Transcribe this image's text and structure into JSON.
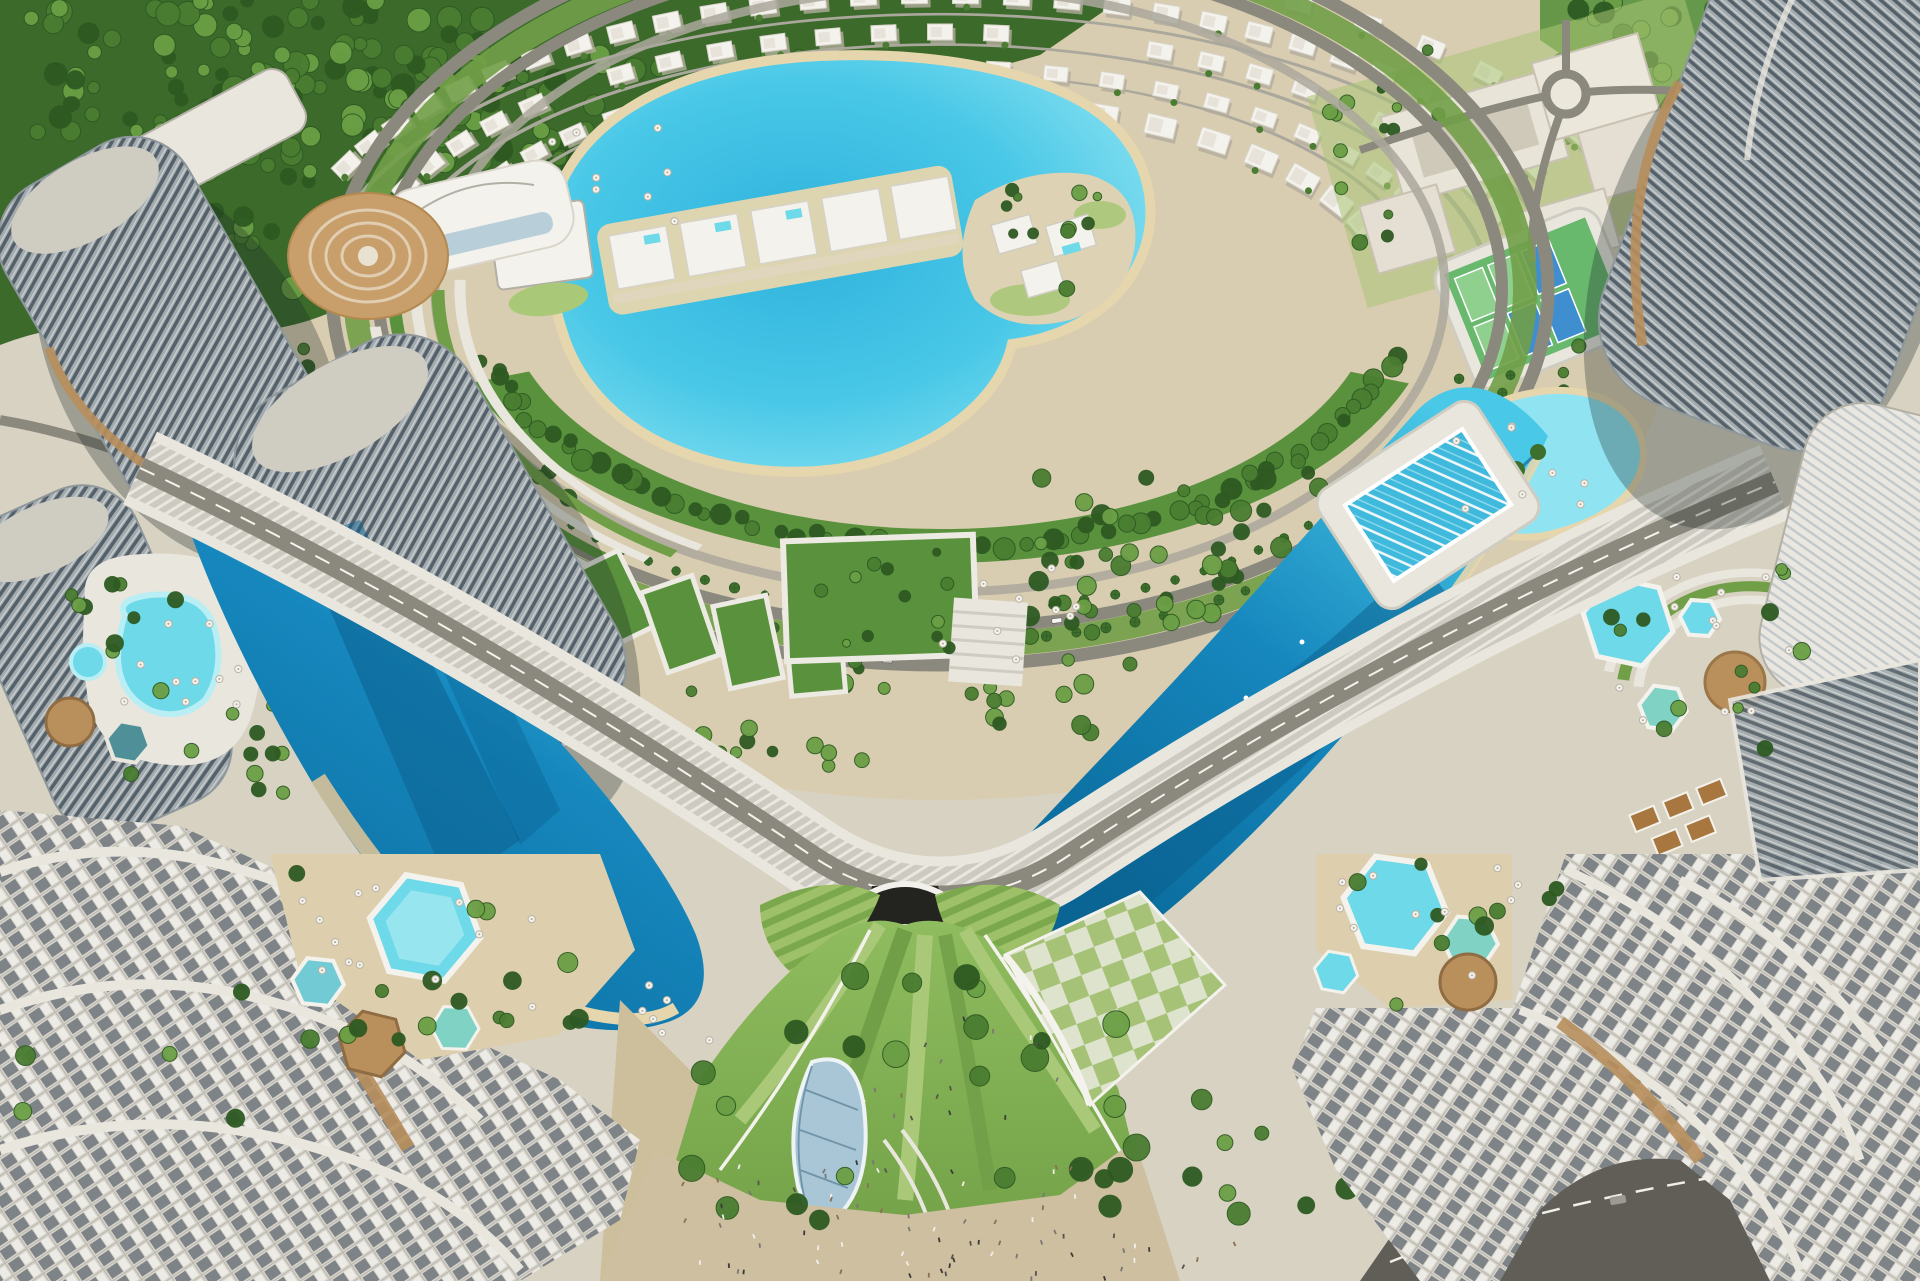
{
  "palette": {
    "ground": "#d8d2c2",
    "groundWarm": "#dbc9a4",
    "sandPath": "#cdbf9b",
    "beach": "#e6d6ad",
    "forestDark": "#3c6a2b",
    "forestMid": "#59913d",
    "lawn": "#8cb45e",
    "lawnLight": "#a9c878",
    "lawnDark": "#719f48",
    "treeDark": "#2e5a22",
    "treeMid": "#4a7d31",
    "treeLight": "#6b9f45",
    "palmGreen": "#3d6f2d",
    "lagoonCore": "#2fb2dd",
    "lagoonMid": "#49c8e7",
    "lagoonLight": "#90e4f2",
    "lagoonDeep": "#1687bd",
    "lagoonAbyss": "#0b6c9d",
    "lagoonShadow": "#0a5d8c",
    "poolAqua": "#6ed9e8",
    "poolPale": "#b8eef4",
    "roadLight": "#aaa79c",
    "roadMid": "#8b897e",
    "roadDark": "#6f6d64",
    "asphalt": "#605e57",
    "white": "#f4f2ec",
    "offWhite": "#e9e6de",
    "concrete": "#cfccc2",
    "concreteShade": "#b2afa4",
    "towerFacade": "#a2aaad",
    "windowDark": "#515e66",
    "bronze": "#b78e5c",
    "wood": "#b98f5c",
    "glass": "#a9c6d6",
    "glassDark": "#6f93a8",
    "tan": "#c89f6b",
    "checkerLight": "#dde3cc",
    "courtGreen": "#68b86d",
    "courtBlue": "#3f8fd0",
    "shadow": "rgba(25,40,35,0.30)"
  },
  "generators": {
    "treeClusters": [
      {
        "layer": "gen-forest",
        "x": 30,
        "y": 0,
        "w": 460,
        "h": 140,
        "n": 95,
        "rmin": 6,
        "rmax": 13,
        "seed": 11
      },
      {
        "layer": "gen-forest",
        "x": 380,
        "y": 55,
        "w": 340,
        "h": 120,
        "n": 60,
        "rmin": 6,
        "rmax": 12,
        "seed": 12
      },
      {
        "layer": "gen-forest",
        "x": 150,
        "y": 120,
        "w": 280,
        "h": 170,
        "n": 55,
        "rmin": 6,
        "rmax": 12,
        "seed": 13
      },
      {
        "layer": "gen-forest",
        "x": 520,
        "y": 130,
        "w": 230,
        "h": 120,
        "n": 38,
        "rmin": 5,
        "rmax": 10,
        "seed": 14
      },
      {
        "layer": "gen-forest",
        "x": 690,
        "y": 55,
        "w": 260,
        "h": 100,
        "n": 32,
        "rmin": 5,
        "rmax": 10,
        "seed": 15
      },
      {
        "layer": "gen-forest",
        "x": 40,
        "y": 210,
        "w": 210,
        "h": 130,
        "n": 40,
        "rmin": 6,
        "rmax": 12,
        "seed": 16
      },
      {
        "layer": "gen-forest",
        "x": 1555,
        "y": 0,
        "w": 365,
        "h": 150,
        "n": 60,
        "rmin": 6,
        "rmax": 11,
        "seed": 17
      },
      {
        "layer": "gen-forest",
        "x": 1690,
        "y": 140,
        "w": 230,
        "h": 120,
        "n": 26,
        "rmin": 5,
        "rmax": 10,
        "seed": 18
      },
      {
        "layer": "gen-campus-trees",
        "x": 1330,
        "y": 50,
        "w": 110,
        "h": 200,
        "n": 15,
        "rmin": 4,
        "rmax": 8,
        "seed": 19
      },
      {
        "layer": "gen-campus-trees",
        "x": 1650,
        "y": 130,
        "w": 110,
        "h": 130,
        "n": 10,
        "rmin": 4,
        "rmax": 8,
        "seed": 20
      },
      {
        "layer": "gen-flank-trees",
        "x": 300,
        "y": 380,
        "w": 170,
        "h": 190,
        "n": 22,
        "rmin": 5,
        "rmax": 10,
        "seed": 21
      },
      {
        "layer": "gen-flank-trees",
        "x": 1040,
        "y": 470,
        "w": 360,
        "h": 170,
        "n": 44,
        "rmin": 6,
        "rmax": 11,
        "seed": 22
      },
      {
        "layer": "gen-flank-trees",
        "x": 450,
        "y": 470,
        "w": 120,
        "h": 130,
        "n": 12,
        "rmin": 5,
        "rmax": 9,
        "seed": 23
      },
      {
        "layer": "gen-flank-trees",
        "x": 560,
        "y": 660,
        "w": 340,
        "h": 110,
        "n": 28,
        "rmin": 5,
        "rmax": 9,
        "seed": 33
      },
      {
        "layer": "gen-flank-trees",
        "x": 960,
        "y": 560,
        "w": 340,
        "h": 180,
        "n": 38,
        "rmin": 6,
        "rmax": 10,
        "seed": 34
      },
      {
        "layer": "gen-flank-trees",
        "x": 150,
        "y": 520,
        "w": 150,
        "h": 280,
        "n": 16,
        "rmin": 4,
        "rmax": 8,
        "seed": 31
      },
      {
        "layer": "gen-park-trees",
        "x": 660,
        "y": 950,
        "w": 480,
        "h": 280,
        "n": 26,
        "rmin": 8,
        "rmax": 14,
        "seed": 24
      },
      {
        "layer": "gen-park-trees",
        "x": 1150,
        "y": 1050,
        "w": 200,
        "h": 180,
        "n": 9,
        "rmin": 7,
        "rmax": 12,
        "seed": 32
      },
      {
        "layer": "gen-deck-trees-left",
        "x": 60,
        "y": 560,
        "w": 220,
        "h": 230,
        "n": 15,
        "rmin": 5,
        "rmax": 9,
        "seed": 25
      },
      {
        "layer": "gen-deck-trees-bl",
        "x": 280,
        "y": 860,
        "w": 350,
        "h": 190,
        "n": 12,
        "rmin": 6,
        "rmax": 10,
        "seed": 26
      },
      {
        "layer": "gen-deck-trees-bl",
        "x": 20,
        "y": 980,
        "w": 380,
        "h": 260,
        "n": 10,
        "rmin": 6,
        "rmax": 10,
        "seed": 35
      },
      {
        "layer": "gen-deck-trees-br",
        "x": 1300,
        "y": 860,
        "w": 300,
        "h": 160,
        "n": 10,
        "rmin": 6,
        "rmax": 10,
        "seed": 27
      },
      {
        "layer": "gen-amenity-trees",
        "x": 1580,
        "y": 560,
        "w": 230,
        "h": 210,
        "n": 13,
        "rmin": 5,
        "rmax": 9,
        "seed": 28
      },
      {
        "layer": "gen-island-trees",
        "x": 975,
        "y": 185,
        "w": 150,
        "h": 140,
        "n": 11,
        "rmin": 4,
        "rmax": 8,
        "seed": 29
      },
      {
        "layer": "gen-plot-trees",
        "x": 795,
        "y": 545,
        "w": 165,
        "h": 105,
        "n": 12,
        "rmin": 4,
        "rmax": 7,
        "seed": 30
      }
    ],
    "treeArcs": [
      {
        "layer": "gen-belt-trees",
        "cx": 940,
        "cy": 290,
        "rx": 468,
        "ry": 256,
        "a0": 15,
        "a1": 165,
        "n": 64,
        "rmin": 6,
        "rmax": 11,
        "jx": 16,
        "jy": 12,
        "seed": 41
      },
      {
        "layer": "gen-belt-trees",
        "cx": 940,
        "cy": 290,
        "rx": 640,
        "ry": 415,
        "a0": 140,
        "a1": 172,
        "n": 11,
        "rmin": 5,
        "rmax": 9,
        "jx": 10,
        "jy": 8,
        "seed": 42
      },
      {
        "layer": "gen-belt-trees",
        "cx": 940,
        "cy": 290,
        "rx": 640,
        "ry": 415,
        "a0": 8,
        "a1": 40,
        "n": 11,
        "rmin": 5,
        "rmax": 9,
        "jx": 10,
        "jy": 8,
        "seed": 43
      }
    ],
    "villaRows": [
      {
        "cx": 940,
        "cy": 290,
        "rx": 655,
        "ry": 295,
        "a0": 205,
        "a1": 335,
        "n": 30,
        "w": 26,
        "h": 17,
        "seed": 51
      },
      {
        "cx": 940,
        "cy": 290,
        "rx": 583,
        "ry": 258,
        "a0": 198,
        "a1": 342,
        "n": 27,
        "w": 25,
        "h": 16,
        "seed": 52
      },
      {
        "cx": 940,
        "cy": 290,
        "rx": 515,
        "ry": 222,
        "a0": 192,
        "a1": 348,
        "n": 25,
        "w": 24,
        "h": 15,
        "seed": 53
      },
      {
        "cx": 940,
        "cy": 290,
        "rx": 450,
        "ry": 188,
        "a0": 218,
        "a1": 340,
        "n": 16,
        "w": 30,
        "h": 20,
        "seed": 54
      },
      {
        "cx": 940,
        "cy": 290,
        "rx": 725,
        "ry": 330,
        "a0": 248,
        "a1": 332,
        "n": 14,
        "w": 26,
        "h": 17,
        "seed": 55
      }
    ],
    "palmArcs": [
      {
        "cx": 940,
        "cy": 290,
        "rx": 588,
        "ry": 352,
        "a0": 14,
        "a1": 166,
        "n": 52,
        "seed": 61
      },
      {
        "cx": 940,
        "cy": 290,
        "rx": 540,
        "ry": 322,
        "a0": 16,
        "a1": 164,
        "n": 44,
        "seed": 62
      }
    ],
    "cars": [
      {
        "cx": 940,
        "cy": 290,
        "rx": 605,
        "ry": 372,
        "a": 26
      },
      {
        "cx": 940,
        "cy": 290,
        "rx": 605,
        "ry": 372,
        "a": 58
      },
      {
        "cx": 940,
        "cy": 290,
        "rx": 605,
        "ry": 372,
        "a": 95
      },
      {
        "cx": 940,
        "cy": 290,
        "rx": 605,
        "ry": 372,
        "a": 130
      },
      {
        "cx": 940,
        "cy": 290,
        "rx": 605,
        "ry": 372,
        "a": 158
      },
      {
        "cx": 940,
        "cy": 290,
        "rx": 562,
        "ry": 338,
        "a": 40
      },
      {
        "cx": 940,
        "cy": 290,
        "rx": 562,
        "ry": 338,
        "a": 78
      },
      {
        "cx": 940,
        "cy": 290,
        "rx": 562,
        "ry": 338,
        "a": 112
      },
      {
        "cx": 940,
        "cy": 290,
        "rx": 562,
        "ry": 338,
        "a": 148
      }
    ],
    "umbrellaClusters": [
      {
        "x": 95,
        "y": 600,
        "w": 150,
        "h": 150,
        "n": 10,
        "seed": 71
      },
      {
        "x": 300,
        "y": 870,
        "w": 280,
        "h": 150,
        "n": 13,
        "seed": 72
      },
      {
        "x": 1330,
        "y": 860,
        "w": 190,
        "h": 130,
        "n": 10,
        "seed": 73
      },
      {
        "x": 1590,
        "y": 565,
        "w": 200,
        "h": 170,
        "n": 11,
        "seed": 74
      },
      {
        "x": 545,
        "y": 128,
        "w": 130,
        "h": 100,
        "n": 8,
        "seed": 75
      },
      {
        "x": 930,
        "y": 545,
        "w": 150,
        "h": 120,
        "n": 9,
        "seed": 76
      },
      {
        "x": 1448,
        "y": 422,
        "w": 150,
        "h": 105,
        "n": 8,
        "seed": 77
      },
      {
        "x": 616,
        "y": 982,
        "w": 95,
        "h": 60,
        "n": 6,
        "seed": 78
      }
    ],
    "peopleClusters": [
      {
        "x": 680,
        "y": 1160,
        "w": 470,
        "h": 110,
        "n": 60,
        "seed": 81
      },
      {
        "x": 815,
        "y": 1015,
        "w": 250,
        "h": 120,
        "n": 16,
        "seed": 82
      },
      {
        "x": 880,
        "y": 1232,
        "w": 360,
        "h": 45,
        "n": 18,
        "seed": 83
      }
    ]
  }
}
